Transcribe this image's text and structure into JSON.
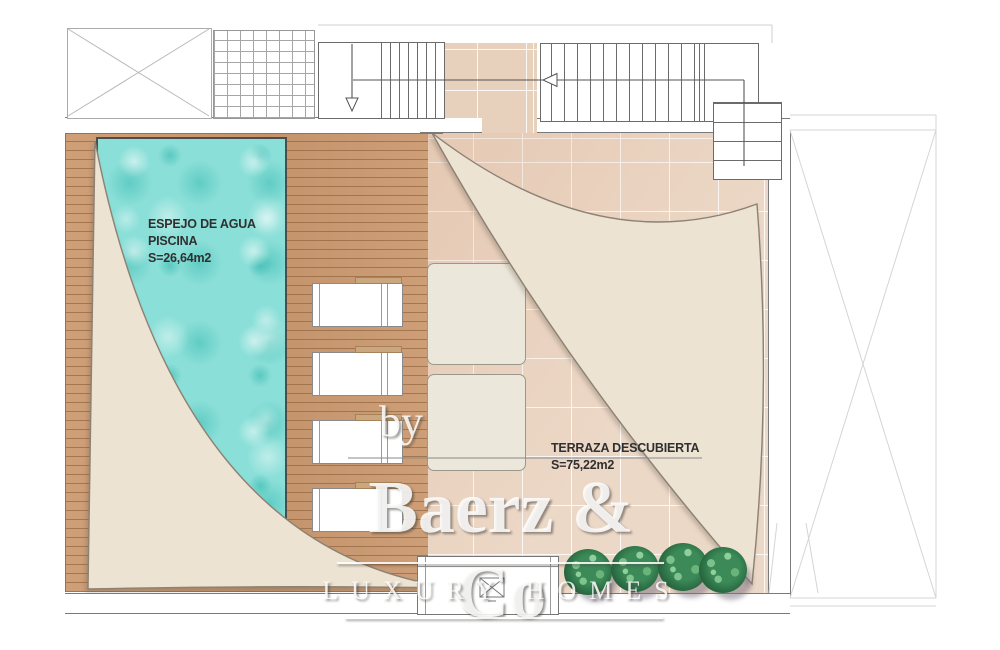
{
  "plan": {
    "pool": {
      "label": [
        "ESPEJO DE AGUA",
        "PISCINA",
        "S=26,64m2"
      ]
    },
    "terrace": {
      "label": [
        "TERRAZA DESCUBIERTA",
        "S=75,22m2"
      ]
    },
    "watermark": {
      "by": "by",
      "brand": "Baerz & Co",
      "tagline": "LUXURY HOMES"
    },
    "icons": {
      "stair_arrow_down": "open-triangle-down",
      "stair_arrow_left": "open-triangle-left"
    },
    "colors": {
      "water": "#8ADFD8",
      "wood": "#C8996F",
      "tile": "#ECD8C7",
      "sail": "#ECE3D3",
      "bush": "#2F7A4C",
      "linework": "#6B6B6B"
    }
  }
}
